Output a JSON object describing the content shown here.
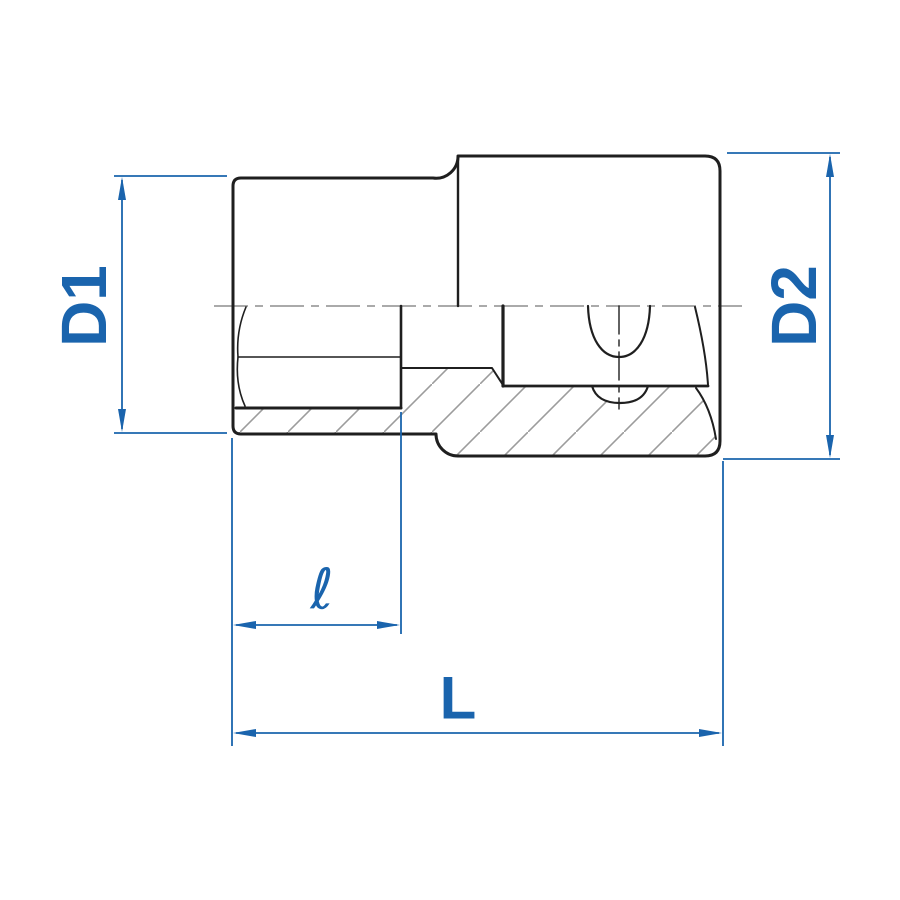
{
  "drawing": {
    "type": "technical-section-drawing",
    "subject": "socket-wrench-cross-section",
    "labels": {
      "diameter_front": "D1",
      "diameter_drive": "D2",
      "hex_depth": "ℓ",
      "total_length": "L"
    },
    "colors": {
      "dimension_blue": "#1a64ad",
      "line_black": "#1f1f1f",
      "hatch_gray": "#9c9c9c",
      "centerline_gray": "#8d8d8d",
      "background": "#ffffff"
    }
  }
}
